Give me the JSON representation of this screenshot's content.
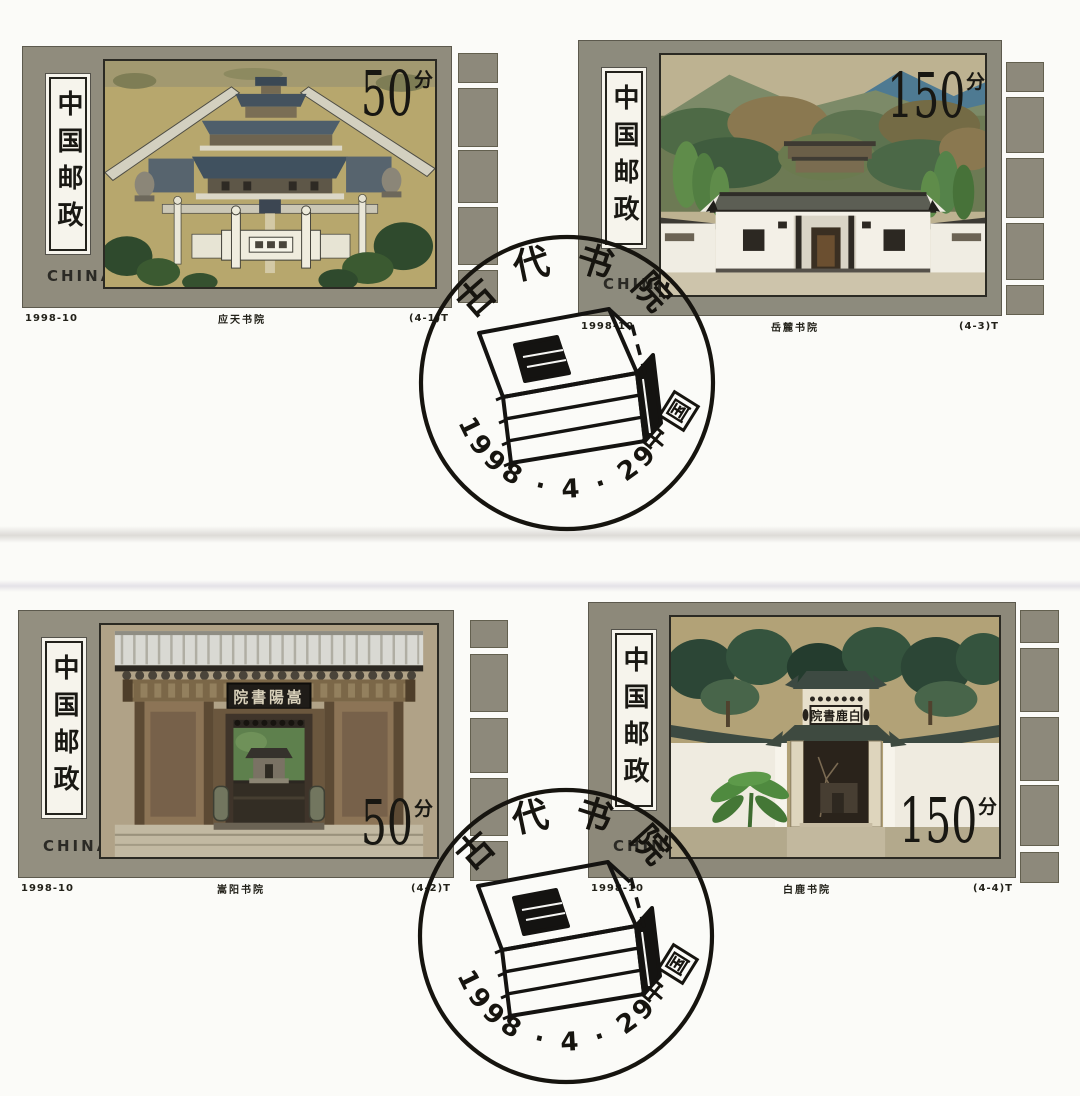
{
  "sheet": {
    "background": "#fbfbf8",
    "selvage_color": "#908c7d",
    "description_colors": {
      "ink": "#181712",
      "caption": "#222119"
    }
  },
  "stamps": [
    {
      "postal": "中国邮政",
      "country": "CHINA",
      "denomination": "50",
      "unit": "分",
      "issue_code": "1998-10",
      "caption": "应天书院",
      "serial": "(4-1)T"
    },
    {
      "postal": "中国邮政",
      "country": "CHINA",
      "denomination": "150",
      "unit": "分",
      "issue_code": "1998-10",
      "caption": "岳麓书院",
      "serial": "(4-3)T"
    },
    {
      "postal": "中国邮政",
      "country": "CHINA",
      "denomination": "50",
      "unit": "分",
      "issue_code": "1998-10",
      "caption": "嵩阳书院",
      "serial": "(4-2)T",
      "plaque": "院書陽嵩"
    },
    {
      "postal": "中国邮政",
      "country": "CHINA",
      "denomination": "150",
      "unit": "分",
      "issue_code": "1998-10",
      "caption": "白鹿书院",
      "serial": "(4-4)T",
      "plaque": "院書鹿白"
    }
  ],
  "postmark": {
    "arc_top": "古代书院",
    "date": "1998 · 4 · 29",
    "country_first": "中",
    "country_boxed": "国",
    "icon": "thread-bound-books-icon",
    "ink_color": "#16140f"
  }
}
